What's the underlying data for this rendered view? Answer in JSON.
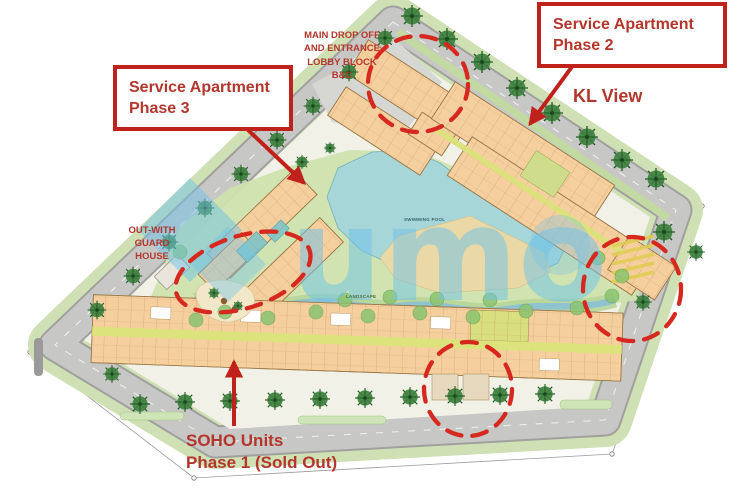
{
  "annotations": {
    "phase2_box": {
      "line1": "Service Apartment",
      "line2": "Phase 2"
    },
    "phase3_box": {
      "line1": "Service Apartment",
      "line2": "Phase 3"
    },
    "kl_view_label": "KL View",
    "drop_off_label": {
      "line1": "MAIN DROP OFF",
      "line2": "AND ENTRANCE",
      "line3": "LOBBY BLOCK B&C"
    },
    "guard_house_label": {
      "line1": "OUT-WITH",
      "line2": "GUARD",
      "line3": "HOUSE"
    },
    "soho_label": {
      "line1": "SOHO Units",
      "line2": "Phase 1 (Sold Out)"
    }
  },
  "plan_labels": {
    "swimming_pool": "SWIMMING POOL",
    "landscape": "LANDSCAPE"
  },
  "watermark": {
    "text": "umo",
    "color": "#6fc2e8"
  },
  "colors": {
    "annotation_red": "#c0211a",
    "annotation_text_red": "#b3362c",
    "building_tan": "#f6cf9e",
    "pool_teal": "#a6d6d8",
    "landscape_green": "#cfe2ad",
    "road_gray": "#c7c7c5",
    "tree_green": "#3f8040"
  }
}
